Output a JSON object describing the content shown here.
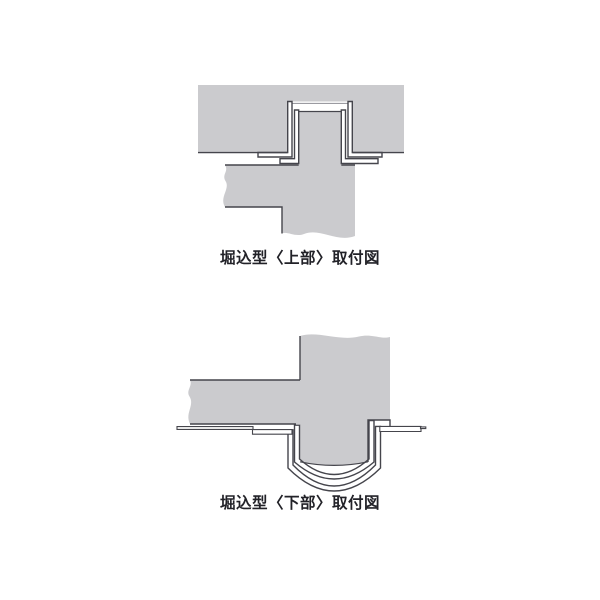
{
  "page": {
    "background": "#ffffff"
  },
  "colors": {
    "page_bg": "#ffffff",
    "panel_gray": "#cbcbce",
    "outline_dark": "#45454c",
    "shadow_line": "#9b9ba1",
    "caption_text": "#222228"
  },
  "diagrams": {
    "upper": {
      "caption": "堀込型〈上部〉取付図"
    },
    "lower": {
      "caption": "堀込型〈下部〉取付図"
    }
  }
}
